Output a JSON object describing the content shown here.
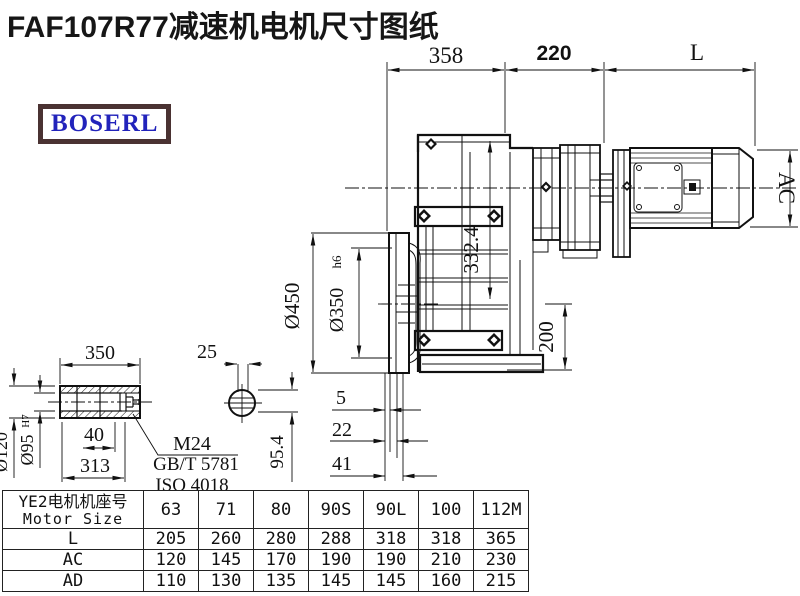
{
  "title": "FAF107R77减速机电机尺寸图纸",
  "logo": {
    "text": "BOSERL",
    "text_color": "#2223bb",
    "border_color": "#4a3232"
  },
  "drawing": {
    "dims": {
      "gearbox_width": "358",
      "adapter_width": "220",
      "motor_length": "L",
      "motor_diameter": "AC",
      "center_height": "332.4",
      "flange_diameter": "Ø450",
      "spigot_diameter": "Ø350",
      "spigot_tolerance": "h6",
      "axis_to_base": "200",
      "flange_offset_1": "5",
      "flange_offset_2": "22",
      "flange_offset_3": "41",
      "shaft_length": "350",
      "keyway_width": "25",
      "shaft_outer_diameter": "Ø120",
      "bore_diameter": "Ø95",
      "bore_tolerance": "H7",
      "plug_depth": "40",
      "shaft_section_length": "313",
      "thread_callout": "M24",
      "standard_1": "GB/T 5781",
      "standard_2": "ISO 4018",
      "across_flats": "95.4"
    }
  },
  "table": {
    "header": {
      "line1": "YE2电机机座号",
      "line2": "Motor Size"
    },
    "columns": [
      "63",
      "71",
      "80",
      "90S",
      "90L",
      "100",
      "112M"
    ],
    "rows": [
      {
        "label": "L",
        "values": [
          "205",
          "260",
          "280",
          "288",
          "318",
          "318",
          "365"
        ]
      },
      {
        "label": "AC",
        "values": [
          "120",
          "145",
          "170",
          "190",
          "190",
          "210",
          "230"
        ]
      },
      {
        "label": "AD",
        "values": [
          "110",
          "130",
          "135",
          "145",
          "145",
          "160",
          "215"
        ]
      }
    ]
  }
}
